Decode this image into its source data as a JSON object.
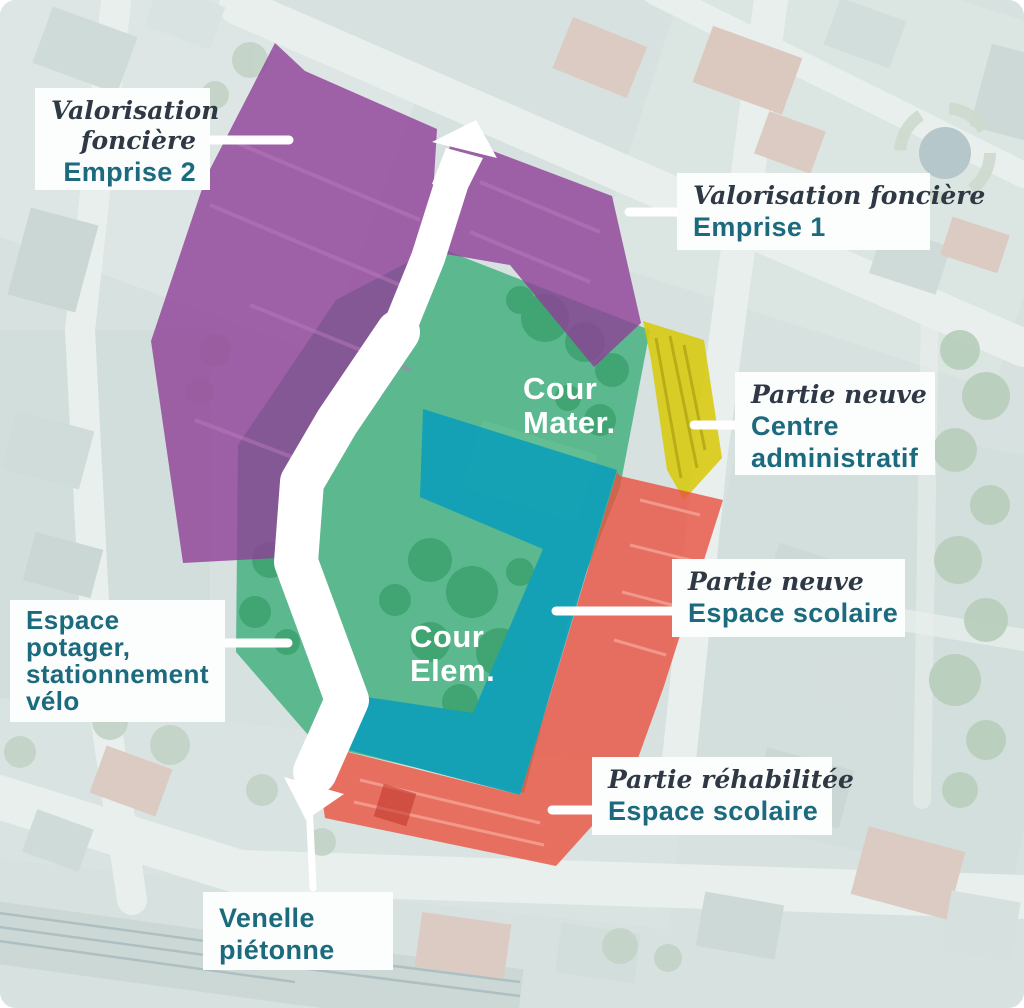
{
  "figure": {
    "kind": "annotated aerial site plan",
    "map_zone_labels": {
      "cour_mater": {
        "line1": "Cour",
        "line2": "Mater."
      },
      "cour_elem": {
        "line1": "Cour",
        "line2": "Elem."
      }
    },
    "callouts": {
      "emprise2": {
        "italic1": "Valorisation",
        "italic2": "foncière",
        "bold1": "Emprise 2"
      },
      "emprise1": {
        "italic1": "Valorisation foncière",
        "bold1": "Emprise 1"
      },
      "centre_admin": {
        "italic1": "Partie neuve",
        "bold1": "Centre",
        "bold2": "administratif"
      },
      "espace_neuf": {
        "italic1": "Partie neuve",
        "bold1": "Espace scolaire"
      },
      "rehabilitee": {
        "italic1": "Partie réhabilitée",
        "bold1": "Espace scolaire"
      },
      "potager": {
        "bold1": "Espace",
        "bold2": "potager,",
        "bold3": "stationnement",
        "bold4": "vélo"
      },
      "venelle": {
        "bold1": "Venelle",
        "bold2": "piétonne"
      }
    },
    "zones": {
      "emprise2": {
        "name": "Valorisation foncière — Emprise 2",
        "color": "#8f3e96"
      },
      "emprise1": {
        "name": "Valorisation foncière — Emprise 1",
        "color": "#8f3e96"
      },
      "green_courtyards": {
        "name": "Cours / espaces verts",
        "color": "#3fae7e"
      },
      "teal_new_school": {
        "name": "Partie neuve — Espace scolaire",
        "color": "#12a0b6"
      },
      "yellow_admin": {
        "name": "Partie neuve — Centre administratif",
        "color": "#d8c90e"
      },
      "red_rehab": {
        "name": "Partie réhabilitée — Espace scolaire",
        "color": "#e85140"
      }
    },
    "accent_colors": {
      "callout_heading_teal": "#1b6a7e",
      "callout_italic_ink": "#2f3945",
      "map_label_white": "#ffffff",
      "arrow_white": "#ffffff"
    }
  }
}
